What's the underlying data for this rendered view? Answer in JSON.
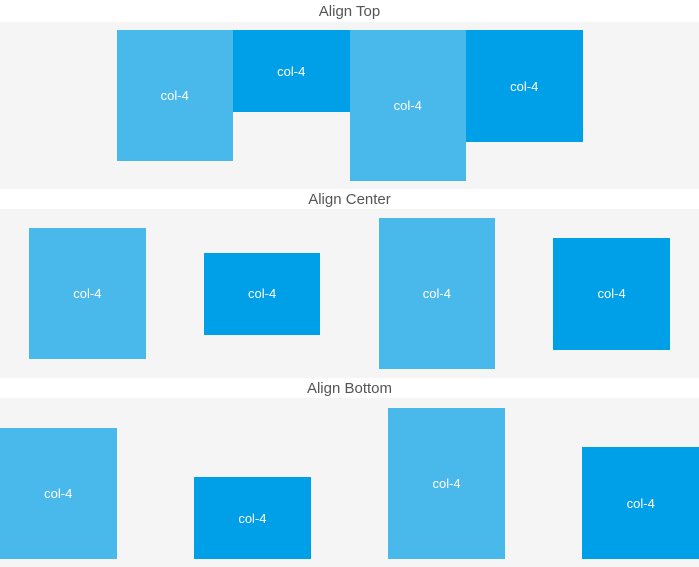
{
  "colors": {
    "light_blue": "#49b9ec",
    "dark_blue": "#00a0e9",
    "band_bg": "#f5f5f5",
    "title_color": "#555555",
    "box_text": "#ffffff"
  },
  "sections": [
    {
      "title": "Align Top",
      "align": "top",
      "justify": "center",
      "boxes": [
        {
          "label": "col-4",
          "variant": "light",
          "height": 131
        },
        {
          "label": "col-4",
          "variant": "dark",
          "height": 82
        },
        {
          "label": "col-4",
          "variant": "light",
          "height": 151
        },
        {
          "label": "col-4",
          "variant": "dark",
          "height": 112
        }
      ]
    },
    {
      "title": "Align Center",
      "align": "middle",
      "justify": "space-around",
      "boxes": [
        {
          "label": "col-4",
          "variant": "light",
          "height": 131
        },
        {
          "label": "col-4",
          "variant": "dark",
          "height": 82
        },
        {
          "label": "col-4",
          "variant": "light",
          "height": 151
        },
        {
          "label": "col-4",
          "variant": "dark",
          "height": 112
        }
      ]
    },
    {
      "title": "Align Bottom",
      "align": "bottom",
      "justify": "space-between",
      "boxes": [
        {
          "label": "col-4",
          "variant": "light",
          "height": 131
        },
        {
          "label": "col-4",
          "variant": "dark",
          "height": 82
        },
        {
          "label": "col-4",
          "variant": "light",
          "height": 151
        },
        {
          "label": "col-4",
          "variant": "dark",
          "height": 112
        }
      ]
    }
  ]
}
